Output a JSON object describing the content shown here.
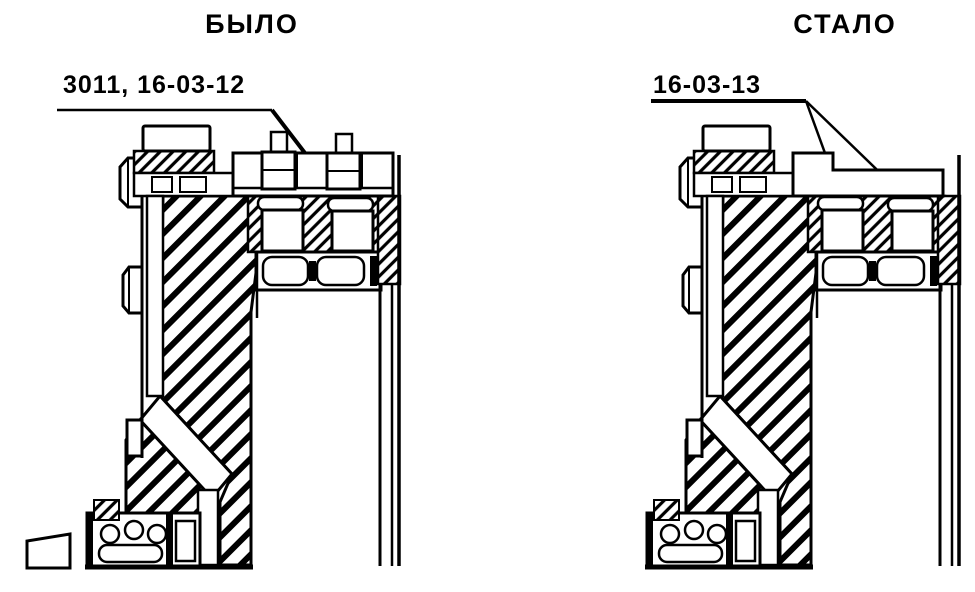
{
  "figure": {
    "kind": "technical-drawing-comparison",
    "description_visible_text_only": true
  },
  "panels": [
    {
      "id": "before",
      "title": "БЫЛО",
      "label": "3011, 16-03-12"
    },
    {
      "id": "after",
      "title": "СТАЛО",
      "label": "16-03-13"
    }
  ],
  "colors": {
    "ink": "#000000",
    "paper": "#ffffff"
  }
}
